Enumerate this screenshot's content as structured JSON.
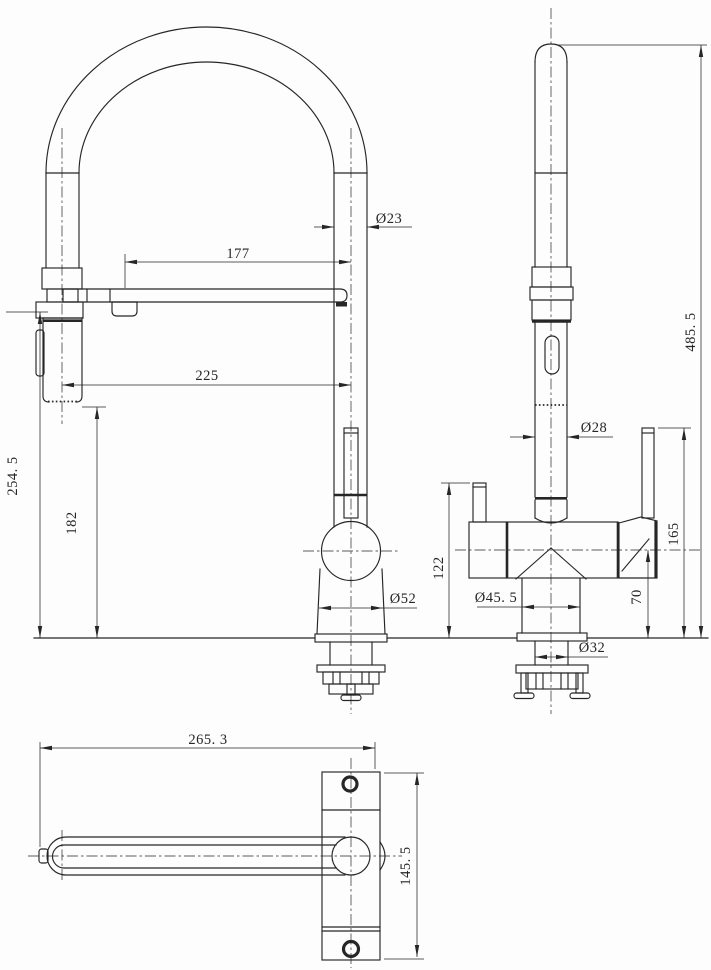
{
  "theme": {
    "background": "#fdfdfd",
    "line_color": "#262626"
  },
  "dims": {
    "spout_tube_dia": "Ø23",
    "upper_reach": "177",
    "spray_reach": "225",
    "spray_top_height": "254. 5",
    "spray_clearance_height": "182",
    "body_dia": "Ø52",
    "total_height": "485. 5",
    "riser_dia": "Ø28",
    "left_handle_height": "122",
    "right_handle_height": "165",
    "handle_base_height": "70",
    "lower_body_dia": "Ø45. 5",
    "shank_dia": "Ø32",
    "plan_total_length": "265. 3",
    "plan_body_length": "145. 5"
  }
}
